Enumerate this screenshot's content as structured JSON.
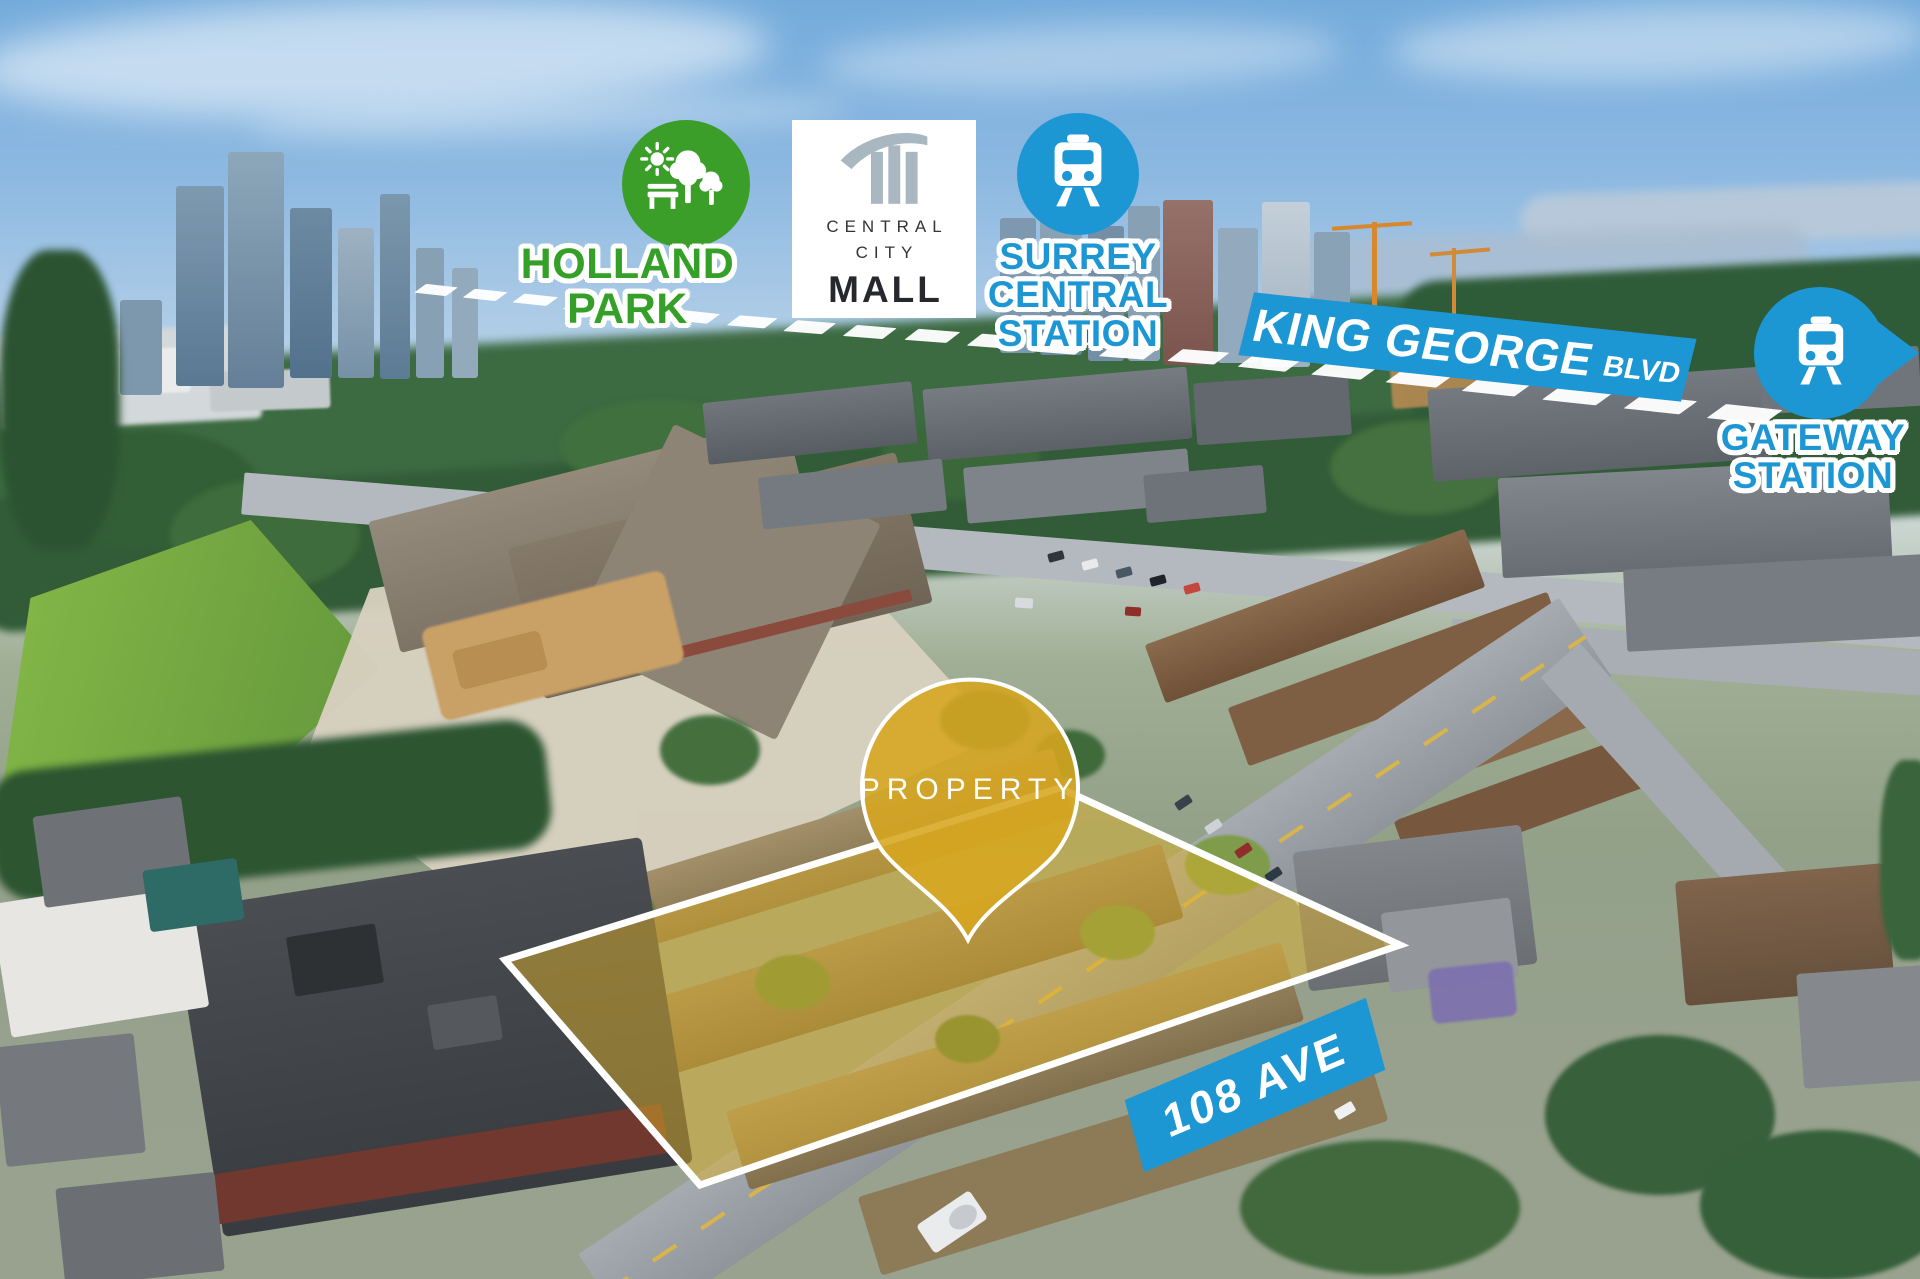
{
  "markers": {
    "holland_park": {
      "lines": [
        "HOLLAND",
        "PARK"
      ]
    },
    "central_city_mall": {
      "lines": [
        "CENTRAL",
        "CITY",
        "MALL"
      ]
    },
    "surrey_central_station": {
      "lines": [
        "SURREY",
        "CENTRAL",
        "STATION"
      ]
    },
    "king_george_blvd": {
      "name": "KING GEORGE",
      "suffix": "BLVD"
    },
    "gateway_station": {
      "lines": [
        "GATEWAY",
        "STATION"
      ]
    },
    "property_pin": {
      "label": "PROPERTY"
    },
    "street_108": {
      "label": "108 AVE"
    }
  },
  "colors": {
    "transit_blue": "#1d96d4",
    "park_green": "#3a9e28",
    "property_gold": "#d7a61f",
    "boundary_white": "#ffffff",
    "mall_logo_gray": "#a9b7c0"
  },
  "icons": {
    "holland_park": "park-trees-bench-sun-icon",
    "surrey_central_station": "train-icon",
    "gateway_station": "train-icon-right-arrow-marker",
    "central_city_mall": "tower-swoosh-icon",
    "property_pin": "map-pin-icon"
  }
}
